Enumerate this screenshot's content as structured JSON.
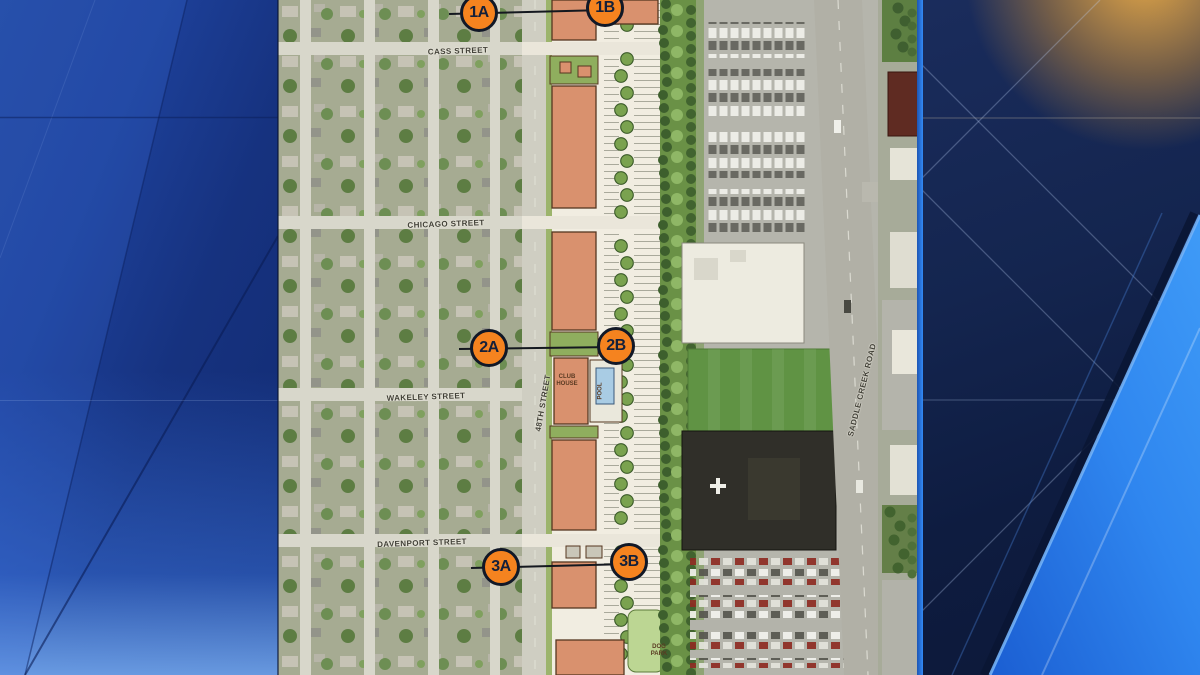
{
  "map": {
    "markers": [
      {
        "label": "1A",
        "x": 479,
        "y": 13
      },
      {
        "label": "1B",
        "x": 605,
        "y": 8
      },
      {
        "label": "2A",
        "x": 489,
        "y": 348
      },
      {
        "label": "2B",
        "x": 616,
        "y": 346
      },
      {
        "label": "3A",
        "x": 501,
        "y": 567
      },
      {
        "label": "3B",
        "x": 629,
        "y": 562
      }
    ],
    "connectors": [
      {
        "x1": 449,
        "y1": 13,
        "x2": 605,
        "y2": 9
      },
      {
        "x1": 459,
        "y1": 348,
        "x2": 616,
        "y2": 346
      },
      {
        "x1": 471,
        "y1": 567,
        "x2": 629,
        "y2": 563
      }
    ],
    "street_labels": [
      {
        "text": "CASS STREET",
        "x": 458,
        "y": 51,
        "rotate": -2
      },
      {
        "text": "CHICAGO STREET",
        "x": 446,
        "y": 224,
        "rotate": -2
      },
      {
        "text": "WAKELEY STREET",
        "x": 426,
        "y": 397,
        "rotate": -2
      },
      {
        "text": "DAVENPORT STREET",
        "x": 422,
        "y": 543,
        "rotate": -2
      },
      {
        "text": "48TH STREET",
        "x": 543,
        "y": 403,
        "rotate": -80
      },
      {
        "text": "SADDLE CREEK ROAD",
        "x": 862,
        "y": 390,
        "rotate": -76
      }
    ],
    "plan_labels": [
      {
        "text": "CLUB\nHOUSE",
        "x": 567,
        "y": 381,
        "rotate": 0
      },
      {
        "text": "POOL",
        "x": 601,
        "y": 391,
        "rotate": -90
      },
      {
        "text": "DOG\nPARK",
        "x": 659,
        "y": 651,
        "rotate": 0
      }
    ]
  },
  "colors": {
    "marker_fill": "#f5831f",
    "marker_border": "#111827",
    "marker_text": "#14203a",
    "bg_left_base": "#1c3f98",
    "bg_right_base": "#0e1c40",
    "bg_right_glow": "#f0af46",
    "accent_wedge": "#2f8bf2",
    "plan_building": "#d9916e",
    "tree_band": "#6a9146",
    "field_green": "#609344"
  }
}
